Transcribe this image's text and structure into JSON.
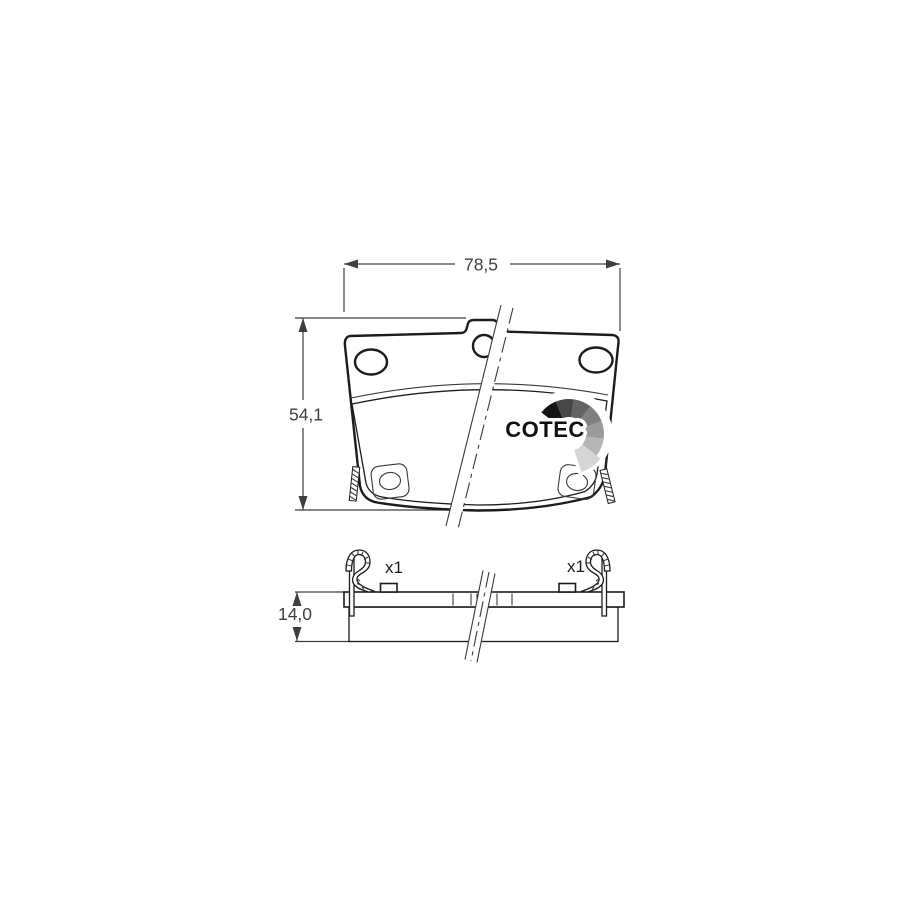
{
  "drawing": {
    "dimensions": {
      "width": "78,5",
      "height": "54,1",
      "thickness": "14,0"
    },
    "accessories": {
      "left_clip_count": "x1",
      "right_clip_count": "x1"
    },
    "logo": {
      "text": "COTEC"
    },
    "colors": {
      "background": "#ffffff",
      "outline": "#1c1c1c",
      "dimension_line": "#3f3f3f",
      "plate_fill": "#ffffff",
      "friction_material": "#f7b9a3",
      "logo_text": "#0f0f0f",
      "logo_fan_segments": [
        "#161616",
        "#474747",
        "#646464",
        "#808080",
        "#9b9b9b",
        "#b6b6b6",
        "#d6d6d6"
      ]
    }
  }
}
